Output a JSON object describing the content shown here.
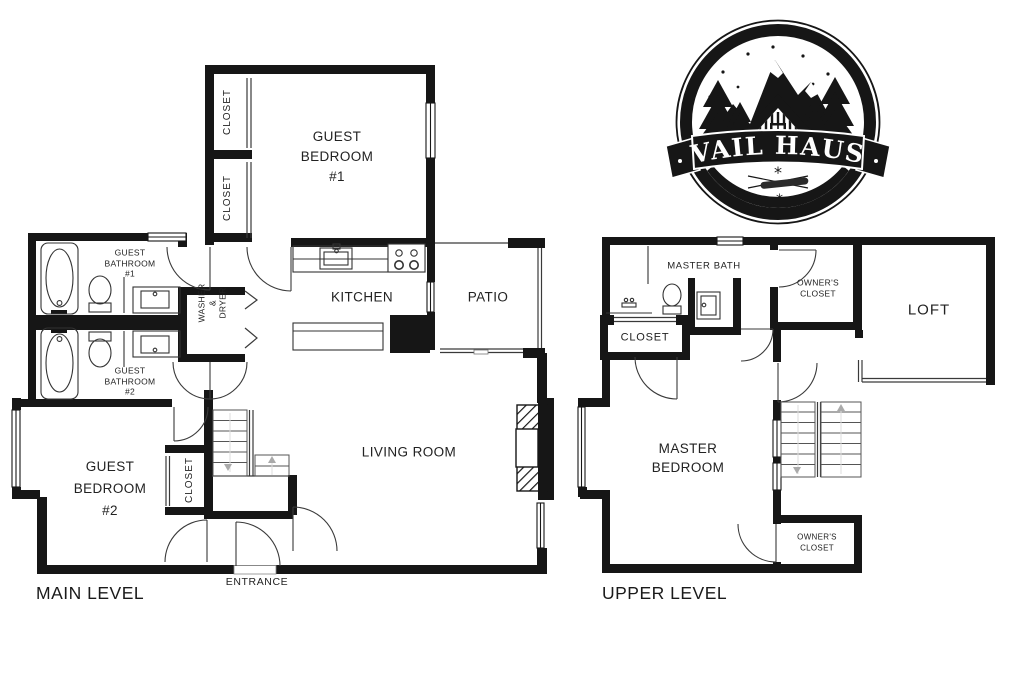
{
  "colors": {
    "walls": "#161616",
    "text": "#222222",
    "background": "#ffffff"
  },
  "logo": {
    "name": "VAIL HAUS"
  },
  "main_level": {
    "title": "MAIN LEVEL",
    "rooms": {
      "closet_top": {
        "label": "CLOSET"
      },
      "closet_mid": {
        "label": "CLOSET"
      },
      "guest_bedroom_1": {
        "l1": "GUEST",
        "l2": "BEDROOM",
        "l3": "#1"
      },
      "guest_bathroom_1": {
        "l1": "GUEST",
        "l2": "BATHROOM",
        "l3": "#1"
      },
      "washer_dryer": {
        "l1": "WASHER",
        "l2": "&",
        "l3": "DRYER"
      },
      "kitchen": {
        "label": "KITCHEN"
      },
      "patio": {
        "label": "PATIO"
      },
      "guest_bathroom_2": {
        "l1": "GUEST",
        "l2": "BATHROOM",
        "l3": "#2"
      },
      "guest_bedroom_2": {
        "l1": "GUEST",
        "l2": "BEDROOM",
        "l3": "#2"
      },
      "closet_stairs": {
        "label": "CLOSET"
      },
      "living_room": {
        "label": "LIVING ROOM"
      },
      "entrance": {
        "label": "ENTRANCE"
      }
    }
  },
  "upper_level": {
    "title": "UPPER LEVEL",
    "rooms": {
      "master_bath": {
        "label": "MASTER BATH"
      },
      "closet": {
        "label": "CLOSET"
      },
      "owners_closet_top": {
        "l1": "OWNER'S",
        "l2": "CLOSET"
      },
      "loft": {
        "label": "LOFT"
      },
      "master_bedroom": {
        "l1": "MASTER",
        "l2": "BEDROOM"
      },
      "owners_closet_bottom": {
        "l1": "OWNER'S",
        "l2": "CLOSET"
      }
    }
  }
}
